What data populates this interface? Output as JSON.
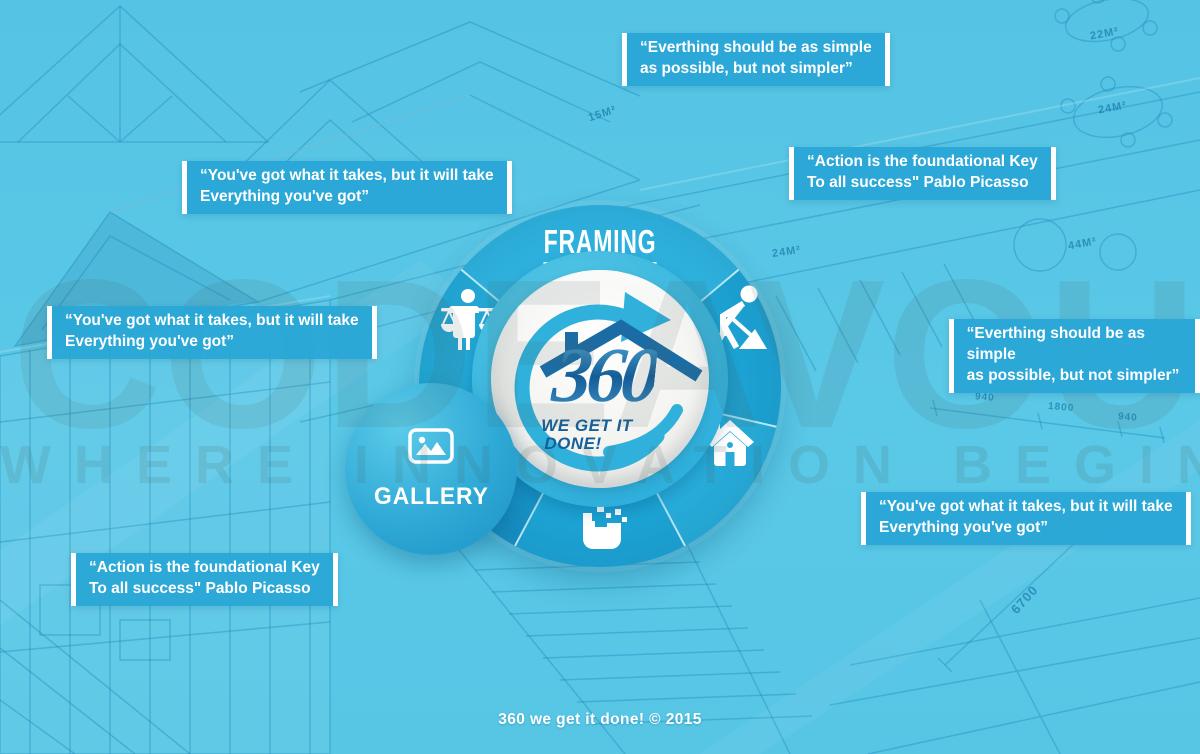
{
  "colors": {
    "background": "#5AC8E7",
    "accent_blue": "#29A7D6",
    "wheel_blue": "#1CA2D3",
    "wheel_top_blue": "#2EB1DE",
    "logo_dark_blue": "#155C96",
    "roof_blue": "#1B6CA5",
    "white": "#FFFFFF"
  },
  "watermark": {
    "line1": "CODEAVOUR",
    "line2": "WHERE INNOVATION BEGINS"
  },
  "wheel": {
    "segments": [
      {
        "name": "framing",
        "label": "FRAMING"
      },
      {
        "name": "worker",
        "icon": "worker-digging-icon"
      },
      {
        "name": "home",
        "icon": "house-icon"
      },
      {
        "name": "materials",
        "icon": "pixel-bucket-icon"
      },
      {
        "name": "inspection",
        "icon": "balance-scales-person-icon"
      }
    ],
    "logo": {
      "number": "360",
      "tagline_line1": "WE GET IT",
      "tagline_line2": "DONE!"
    }
  },
  "gallery": {
    "label": "GALLERY",
    "icon": "image-icon"
  },
  "quotes": [
    {
      "id": "top",
      "text": "“Everthing should be as simple\nas possible, but not simpler”"
    },
    {
      "id": "upper-left",
      "text": "“You've got what it takes, but it will take\nEverything you've got”"
    },
    {
      "id": "upper-right",
      "text": "“Action is the foundational Key\nTo all success\" Pablo Picasso"
    },
    {
      "id": "mid-left",
      "text": "“You've got what it takes, but it will take\nEverything you've got”"
    },
    {
      "id": "mid-right",
      "text": "“Everthing should be as simple\nas possible, but not simpler”"
    },
    {
      "id": "lower-right",
      "text": "“You've got what it takes, but it will take\nEverything you've got”"
    },
    {
      "id": "lower-left",
      "text": "“Action is the foundational Key\nTo all success\" Pablo Picasso"
    }
  ],
  "footer": {
    "text": "360 we get it done! © 2015"
  },
  "background": {
    "labels": [
      {
        "text": "22M²"
      },
      {
        "text": "24M²"
      },
      {
        "text": "44M²"
      },
      {
        "text": "24M²"
      },
      {
        "text": "15M²"
      },
      {
        "text": "940"
      },
      {
        "text": "1800"
      },
      {
        "text": "940"
      },
      {
        "text": "6700"
      }
    ]
  }
}
